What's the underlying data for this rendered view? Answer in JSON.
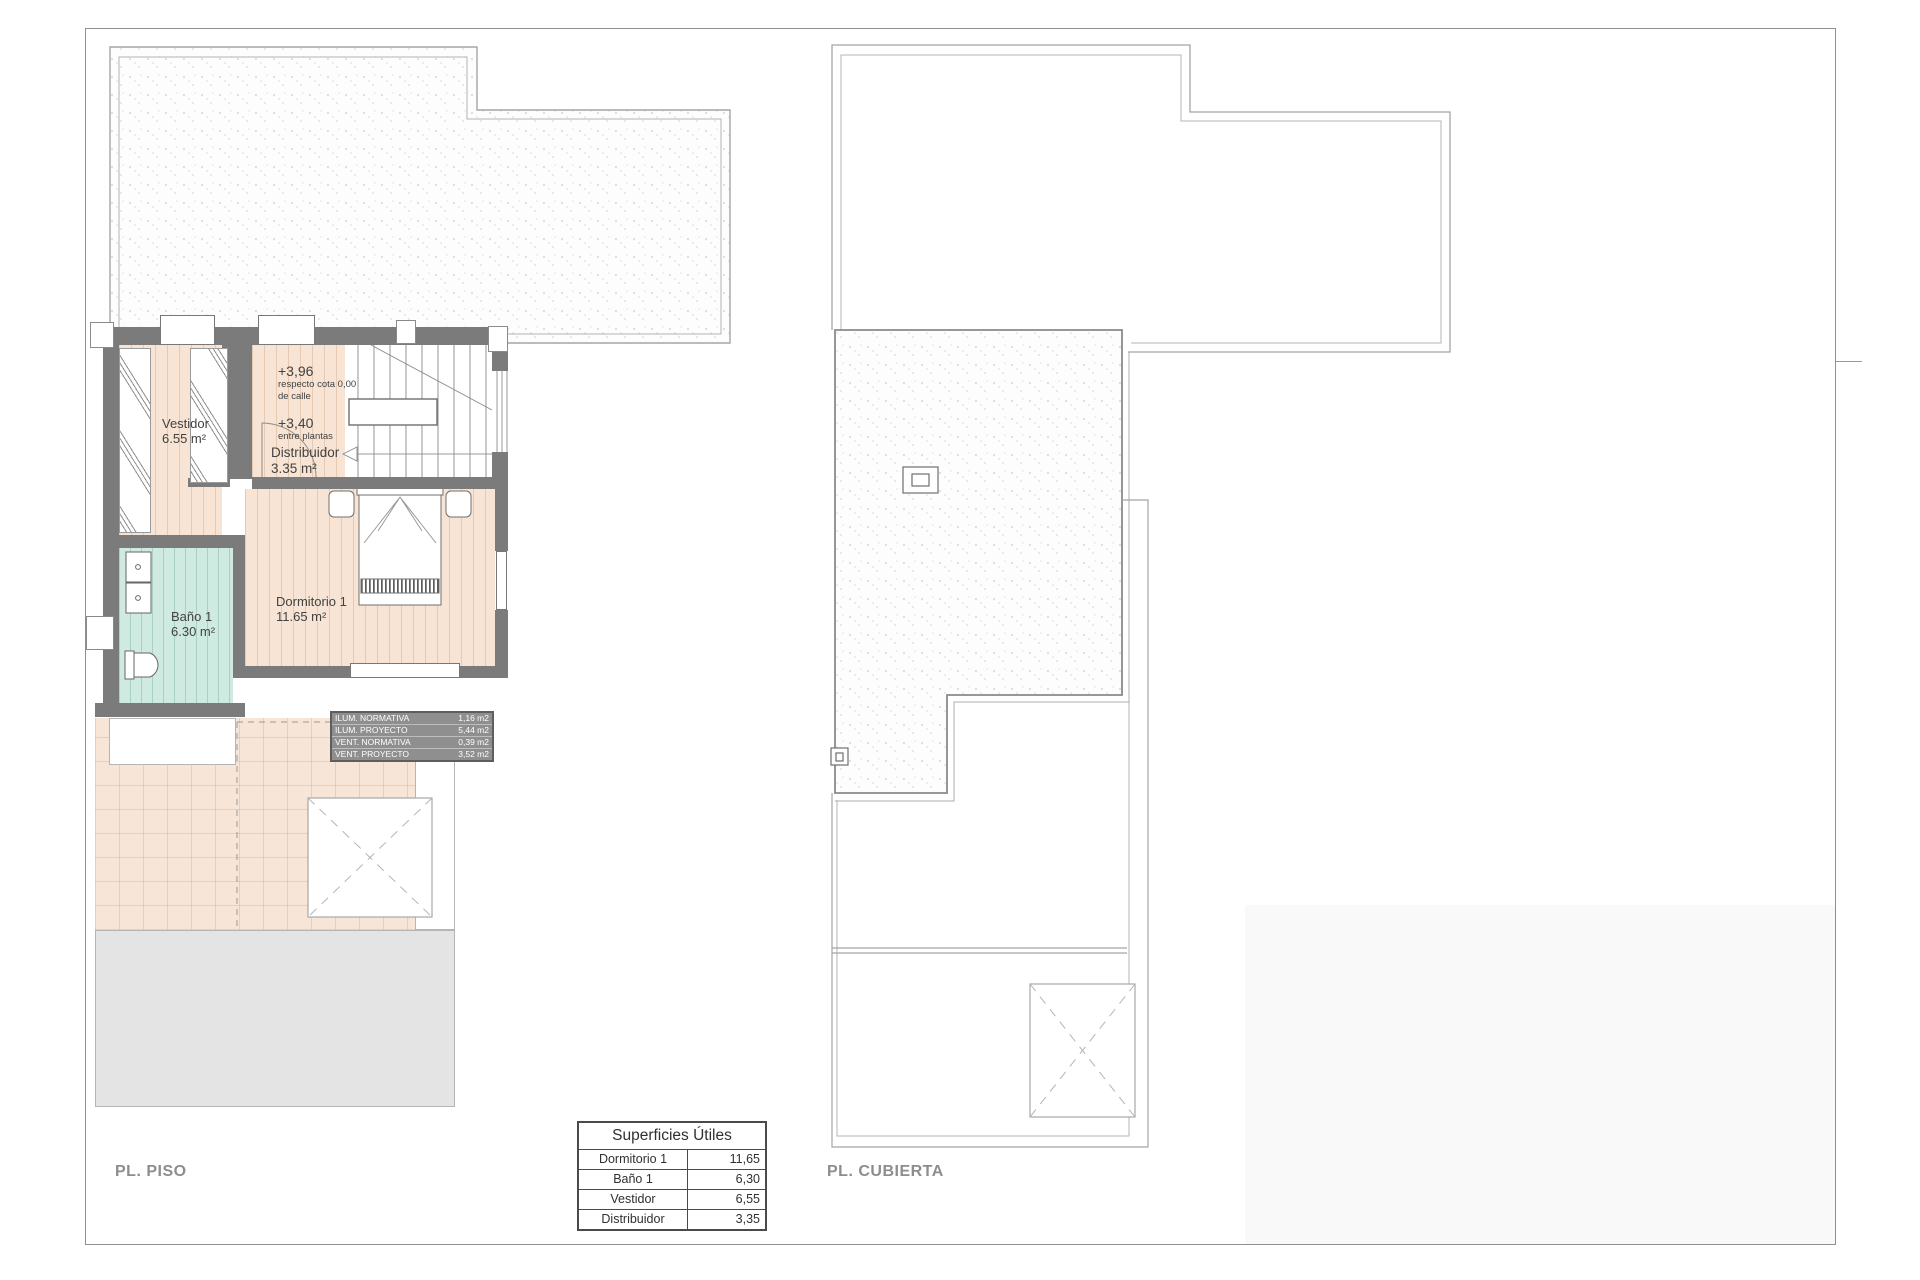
{
  "left_plan": {
    "title": "PL. PISO",
    "annotations": {
      "level_upper": "+3,96",
      "level_upper_note1": "respecto cota 0,00",
      "level_upper_note2": "de calle",
      "level_between": "+3,40",
      "level_between_note": "entre plantas"
    },
    "rooms": {
      "vestidor": {
        "name": "Vestidor",
        "area": "6.55 m²"
      },
      "distribuidor": {
        "name": "Distribuidor",
        "area": "3.35 m²"
      },
      "bano": {
        "name": "Baño 1",
        "area": "6.30 m²"
      },
      "dormitorio": {
        "name": "Dormitorio 1",
        "area": "11.65 m²"
      }
    },
    "vent_table": {
      "rows": [
        {
          "label": "ILUM. NORMATIVA",
          "value": "1,16 m2"
        },
        {
          "label": "ILUM. PROYECTO",
          "value": "5,44 m2"
        },
        {
          "label": "VENT. NORMATIVA",
          "value": "0,39 m2"
        },
        {
          "label": "VENT. PROYECTO",
          "value": "3,52 m2"
        }
      ]
    }
  },
  "right_plan": {
    "title": "PL. CUBIERTA"
  },
  "areas_table": {
    "title": "Superficies Útiles",
    "rows": [
      {
        "label": "Dormitorio 1",
        "value": "11,65"
      },
      {
        "label": "Baño 1",
        "value": "6,30"
      },
      {
        "label": "Vestidor",
        "value": "6,55"
      },
      {
        "label": "Distribuidor",
        "value": "3,35"
      }
    ]
  },
  "colors": {
    "wall": "#7b7b7b",
    "floor": "#f7e4d4",
    "bath_floor": "#cfeae0",
    "title_gray": "#8d8d8d",
    "vent_table_bg": "#8f8f8f"
  }
}
